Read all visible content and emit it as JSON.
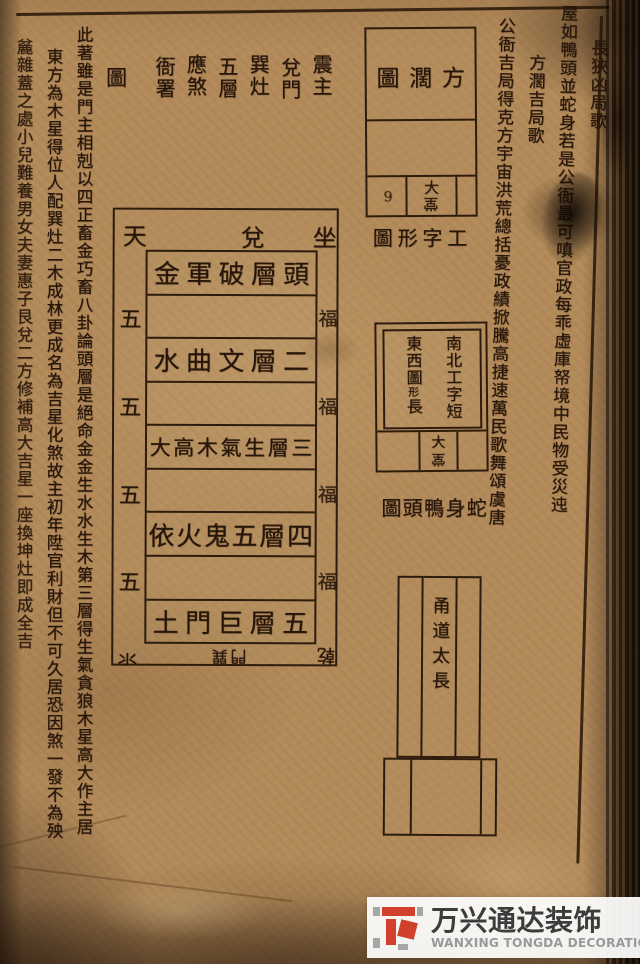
{
  "left_block": {
    "heading_pairs": [
      "震主",
      "兌門",
      "巽灶",
      "五層",
      "應煞",
      "衙署"
    ],
    "heading_tu": "圖",
    "col_a": "此著雖是門主相剋以四正畜金巧畜八卦論頭層是絕命金金生水水生木第三層得生氣貪狼木星高大作主居",
    "col_b": "東方為木星得位人配巽灶二木成林更成名為吉星化煞故主初年陞官利財但不可久居恐因煞一發不為殃",
    "col_c": "麄雜蓋之處小兒難養男女夫妻惠子艮兌二方修補高大吉星一座換坤灶即成全吉"
  },
  "right_block": {
    "title1": "長狹凶局歌",
    "verse1": "屋如鴨頭並蛇身若是公衙最可嗔官政每乖虛庫帑境中民物受災迍",
    "title2": "方濶吉局歌",
    "verse2": "公衙吉局得克方宇宙洪荒總括憂政績掀騰高捷速萬民歌舞頌虞唐"
  },
  "center_diagram": {
    "top_labels": [
      "天",
      "兌",
      "坐"
    ],
    "rows": [
      {
        "text": "頭層破軍金"
      },
      {
        "text": ""
      },
      {
        "text": "二層文曲水"
      },
      {
        "text": ""
      },
      {
        "text": "三層生氣木高大"
      },
      {
        "text": ""
      },
      {
        "text": "四層五鬼火依"
      },
      {
        "text": ""
      },
      {
        "text": "五層巨門土"
      }
    ],
    "left_mark": "五",
    "right_mark": "福",
    "bottom_left_mark": "氺",
    "bottom_center_mark": "巽門",
    "bottom_right_mark": "乾"
  },
  "square_diagram": {
    "caption": "方濶圖",
    "hall": "大堂",
    "corner_mark": "9"
  },
  "gong_caption": "工字形圖",
  "gong_diagram": {
    "col_right": "南北工字短",
    "col_left_pre": "東西圖",
    "col_left_small": "形",
    "col_left_post": "長",
    "hall": "大堂"
  },
  "snake_caption": "蛇身鴨頭圖",
  "aisle_diagram": {
    "label": "甬道太長"
  },
  "watermark": {
    "zh": "万兴通达装饰",
    "en": "WANXING TONGDA DECORATION",
    "red": "#d0402c",
    "gray": "#a6a6a6"
  }
}
